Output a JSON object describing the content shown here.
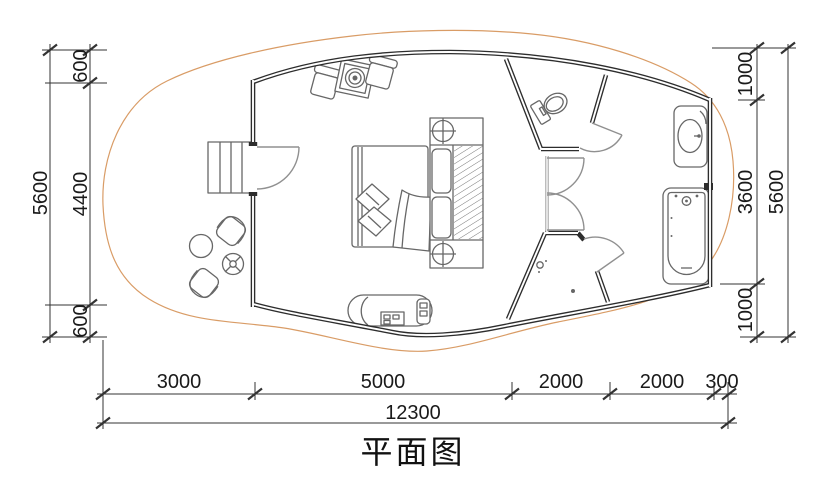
{
  "title": "平面图",
  "dimensions": {
    "left_outer_total": "5600",
    "left_segments": [
      "600",
      "4400",
      "600"
    ],
    "right_segments": [
      "1000",
      "3600",
      "1000"
    ],
    "right_outer_total": "5600",
    "bottom_segments": [
      "3000",
      "5000",
      "2000",
      "2000",
      "300"
    ],
    "bottom_total": "12300"
  },
  "colors": {
    "brick_line": "#e7ad7c",
    "deck_edge": "#d99c66",
    "wall": "#2d2d2d",
    "partition": "#a0a0a0",
    "furniture": "#676767",
    "door": "#909090",
    "dim_line": "#333333",
    "dim_text": "#1a1a1a"
  }
}
